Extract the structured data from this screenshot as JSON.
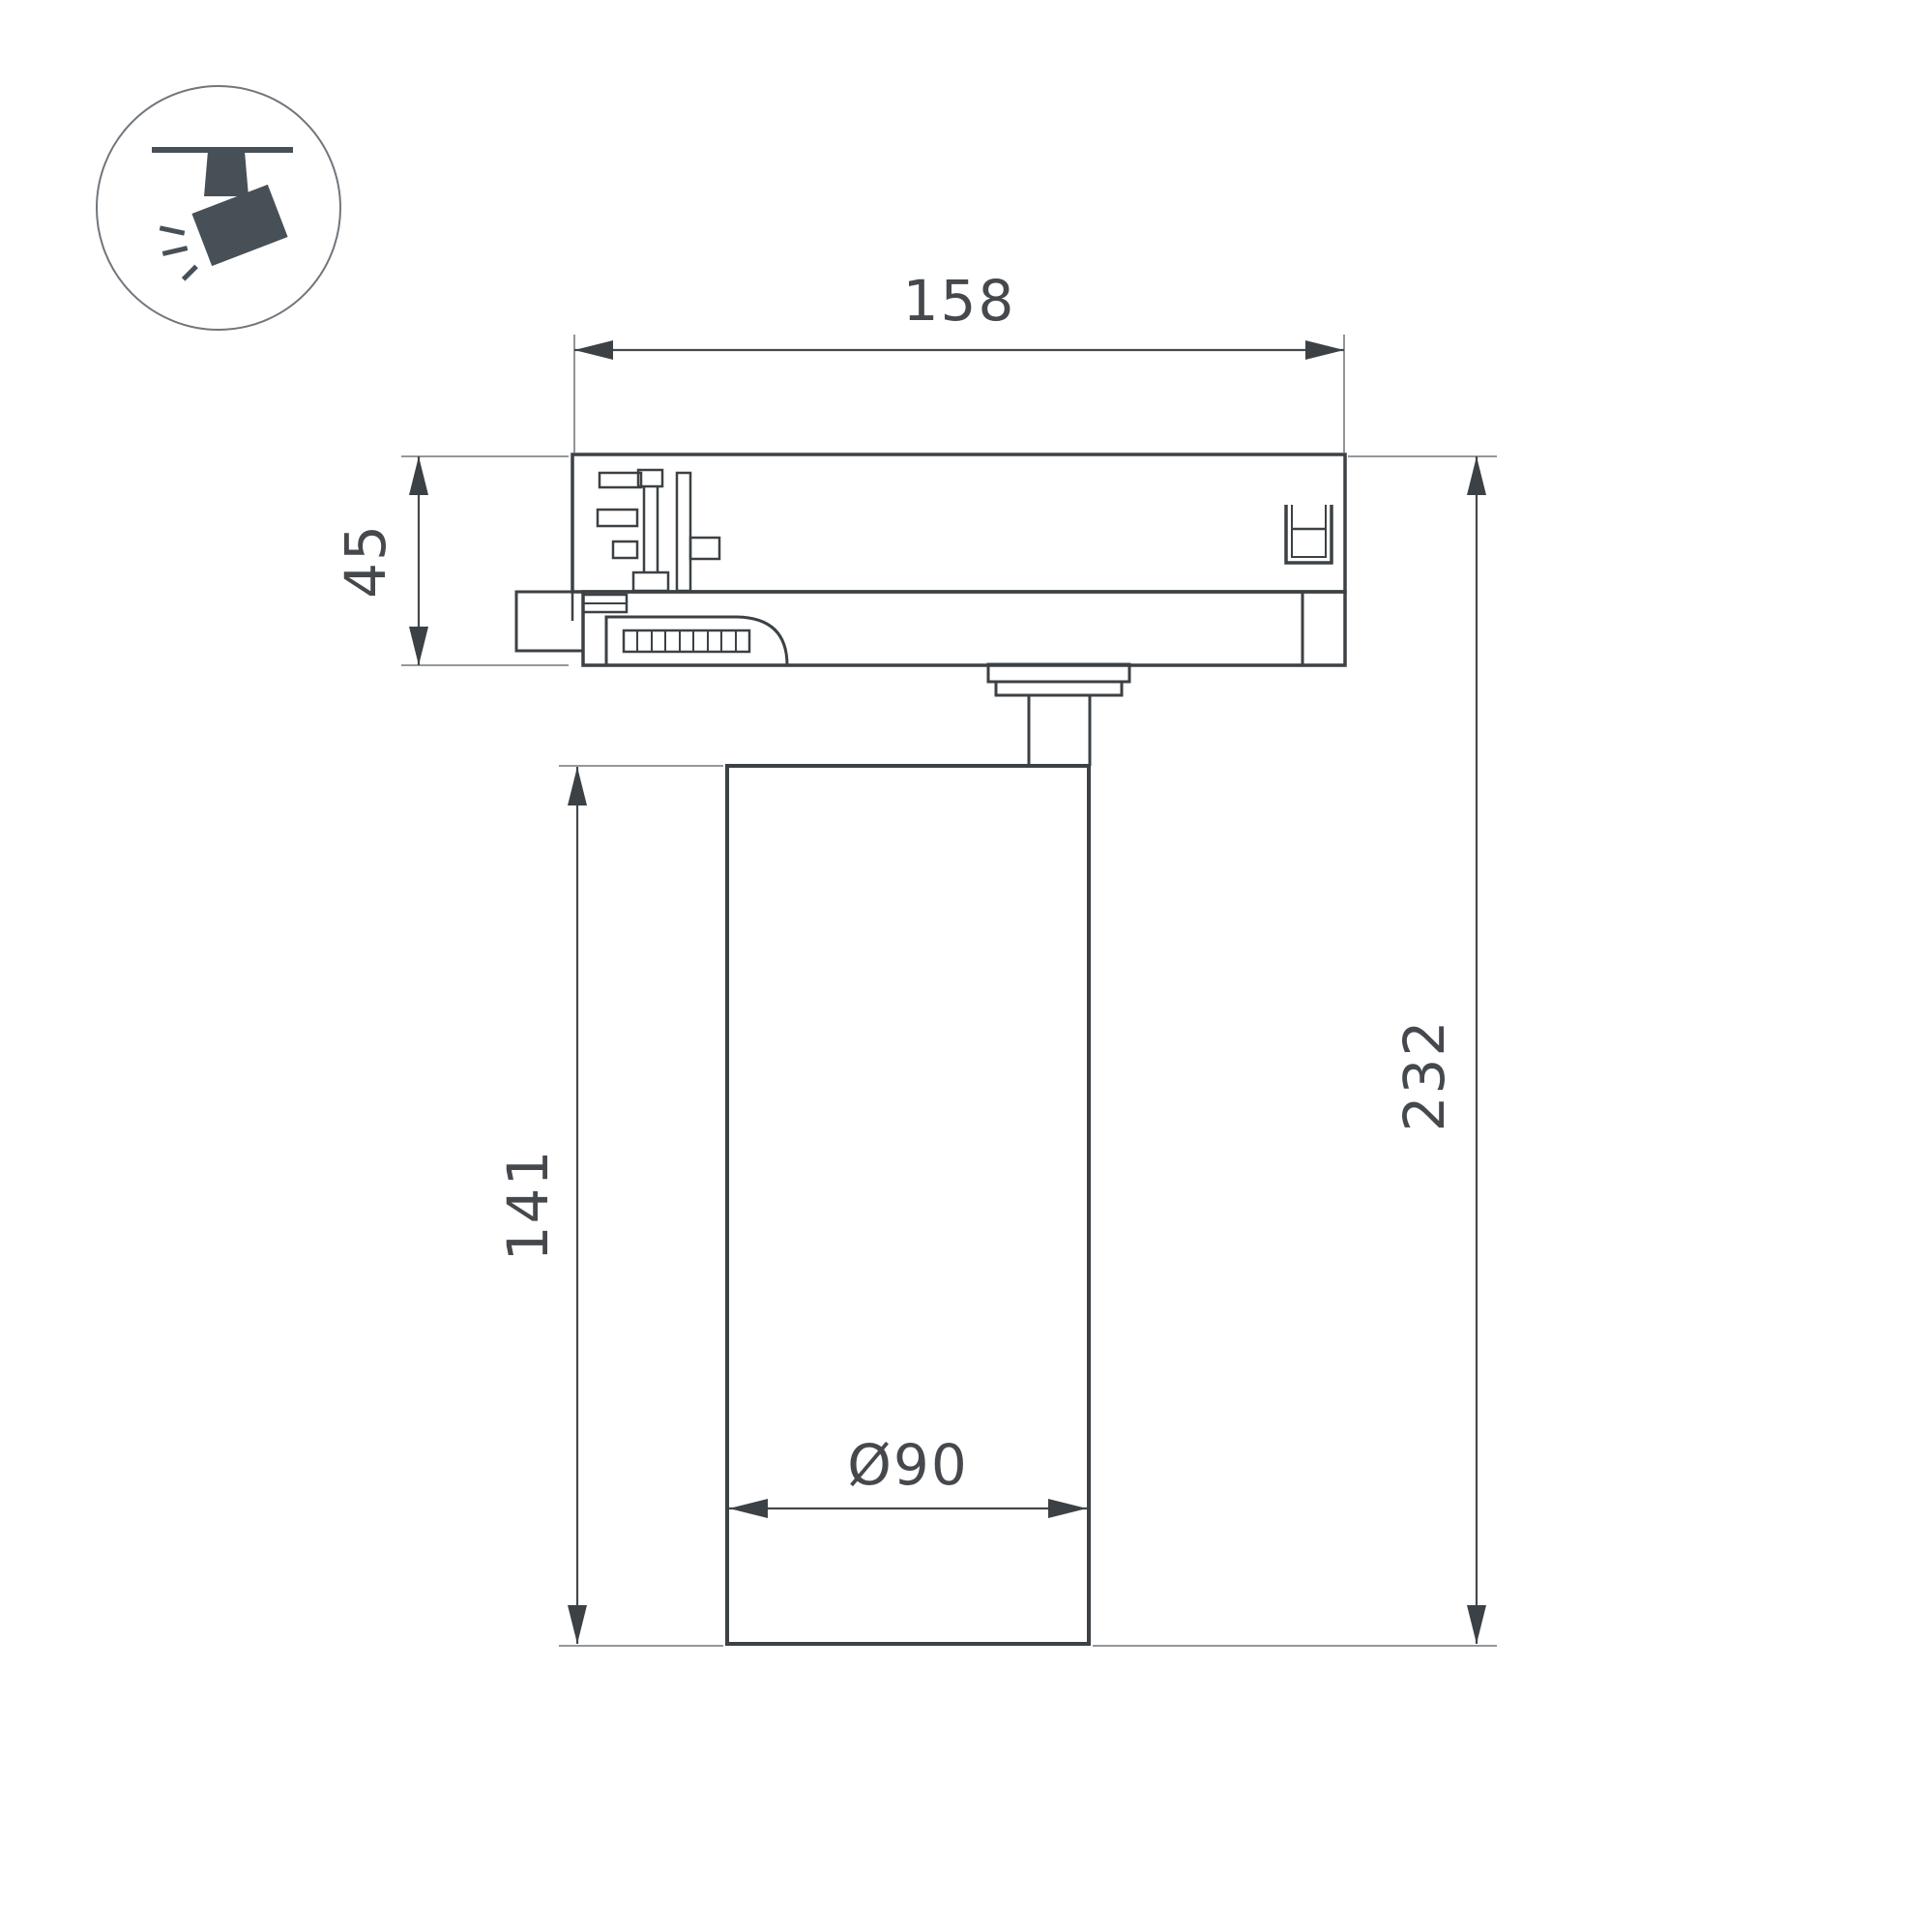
{
  "drawing": {
    "kind": "dimension-drawing",
    "dimensions": {
      "adapter_length": "158",
      "adapter_height": "45",
      "body_height": "141",
      "total_height": "232",
      "body_diameter": "Ø90"
    },
    "icon": {
      "name": "track-spotlight-icon"
    },
    "colors": {
      "outline": "#3c4145",
      "dimension_line": "#45494d",
      "extension_line": "#85898d",
      "icon_fill": "#474f57",
      "background": "#ffffff"
    }
  }
}
